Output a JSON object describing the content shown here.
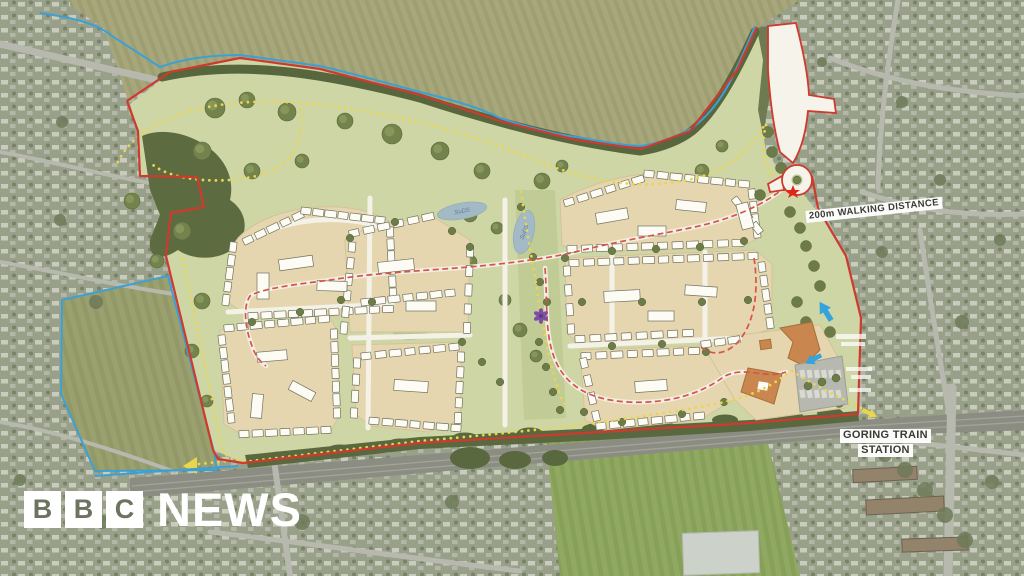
{
  "branding": {
    "blocks": [
      "B",
      "B",
      "C"
    ],
    "news": "NEWS"
  },
  "labels": {
    "walking_distance": "200m WALKING DISTANCE",
    "station_line1": "GORING TRAIN",
    "station_line2": "STATION",
    "suds_pond_1": "SuDS",
    "suds_pond_2": "SuDS"
  },
  "palette": {
    "site_green": "#ced6a5",
    "parcel_beige": "#e5d6b0",
    "boundary_red": "#cf3a2e",
    "boundary_blue": "#3da0d4",
    "path_yellow": "#e9d64f",
    "street_red_dash": "#d6544a",
    "tree_olive": "#74824c",
    "orange_building": "#c9864e",
    "pond_blue": "#a3bac6",
    "marker_purple": "#7b4fa3",
    "arrow_blue": "#35a3dc",
    "label_text": "#3b3b33",
    "logo_white": "#ffffff"
  }
}
